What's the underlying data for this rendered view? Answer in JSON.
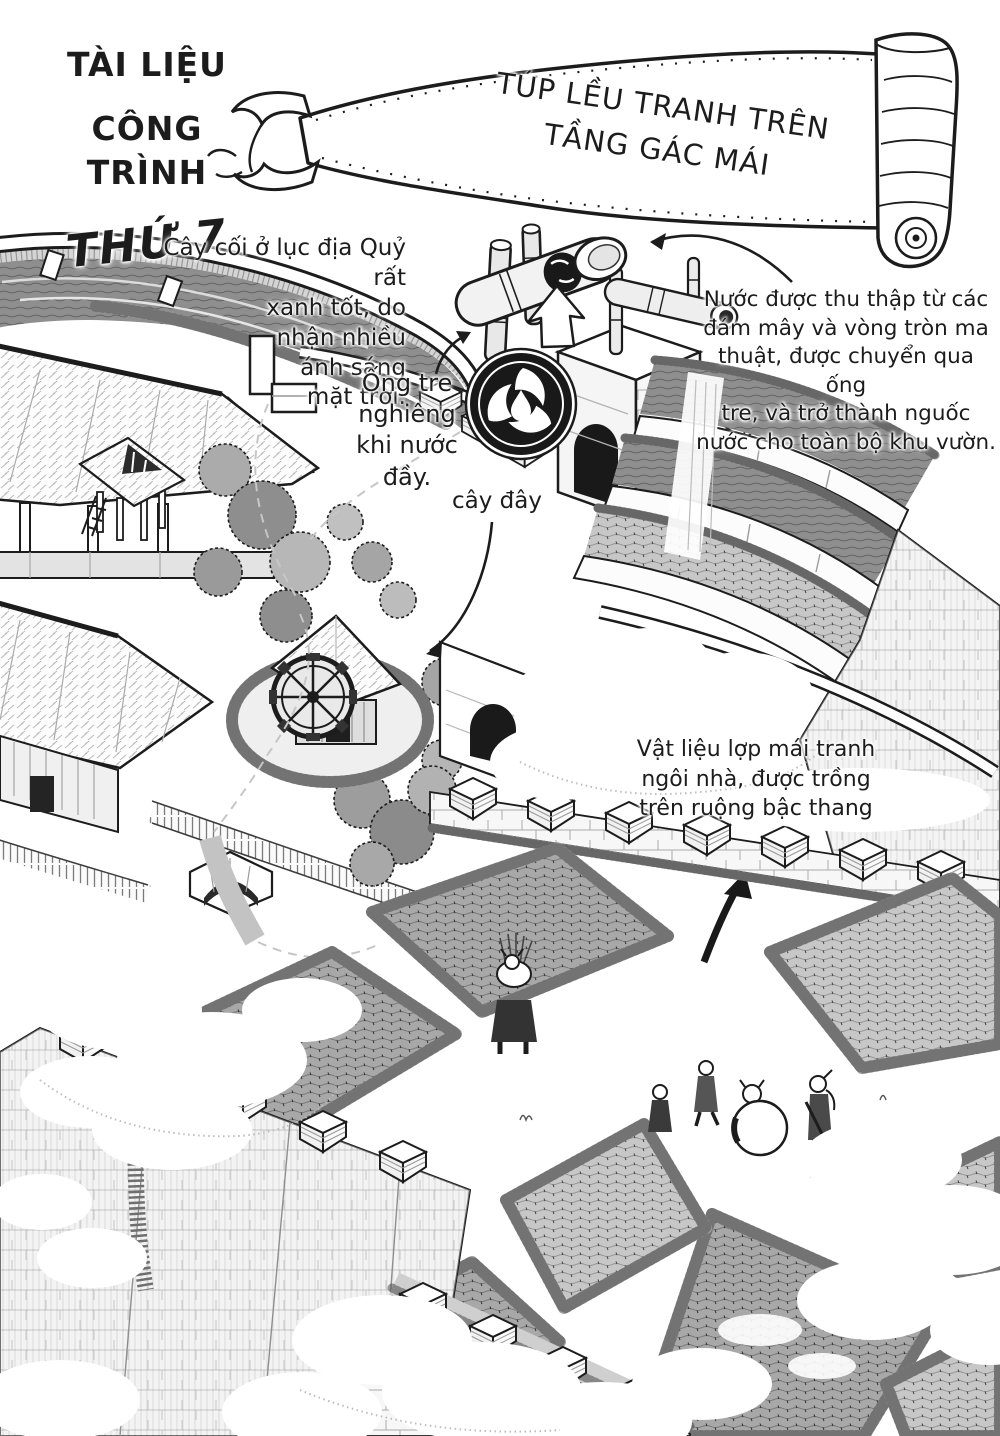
{
  "page": {
    "header": {
      "doc_title_line1": "TÀI LIỆU",
      "doc_title_line2": "CÔNG TRÌNH",
      "doc_title_line3": "THỨ 7",
      "banner_title": "TÚP LỀU TRANH TRÊN\nTẦNG GÁC MÁI"
    },
    "annotations": {
      "sunlight": "Cây cối ở lục địa Quỷ rất\nxanh tốt, do\nnhận nhiều\nánh sáng\nmặt trời.",
      "bamboo_tilt": "Ống tre\nnghiêng\nkhi nước\nđầy.",
      "water_source": "Nước được thu thập từ các\nđám mây và vòng tròn ma\nthuật, được chuyển qua ống\ntre, và trở thành nguốc\nnước cho toàn bộ khu vườn.",
      "plant_here": "cây đây",
      "thatch_material": "Vật liệu lợp mái tranh\nngôi nhà, được trồng\ntrên ruộng bậc thang"
    },
    "colors": {
      "ink": "#1c1c1c",
      "paper": "#ffffff",
      "paddy_dark": "#a8a8a8",
      "paddy_mid": "#c7c7c7",
      "foliage": "#9a9a9a"
    }
  }
}
